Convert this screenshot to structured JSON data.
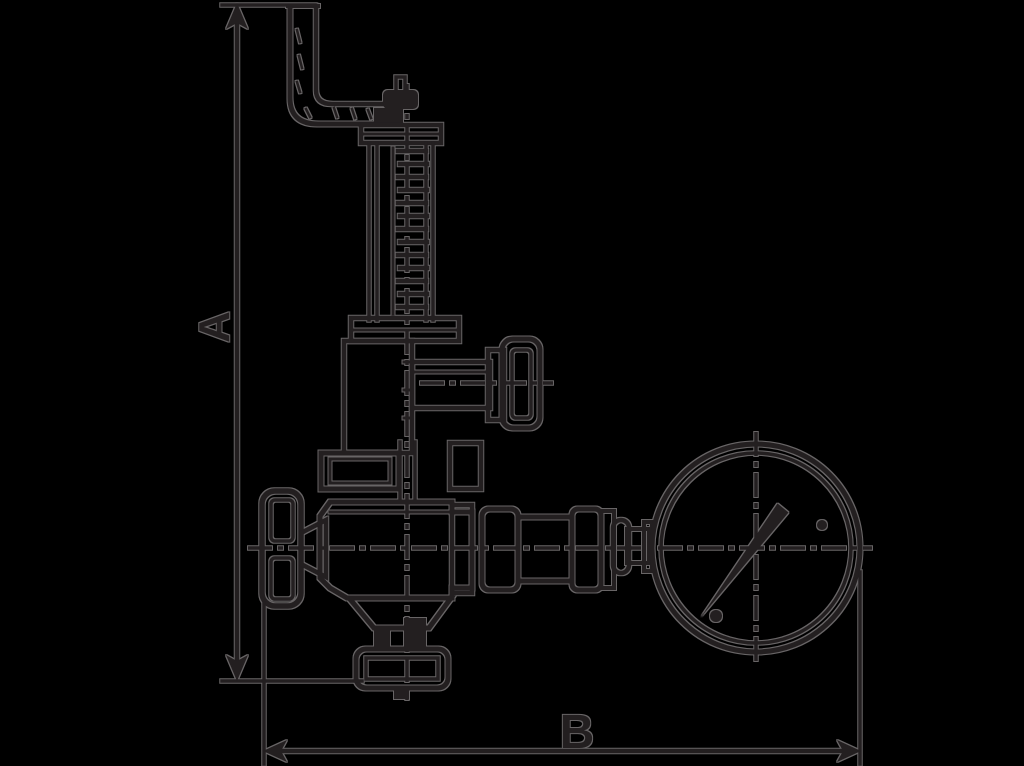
{
  "drawing": {
    "dimension_a_label": "A",
    "dimension_b_label": "B"
  },
  "colors": {
    "background": "#000000",
    "ink": "#231f20",
    "edge": "#827e80"
  }
}
